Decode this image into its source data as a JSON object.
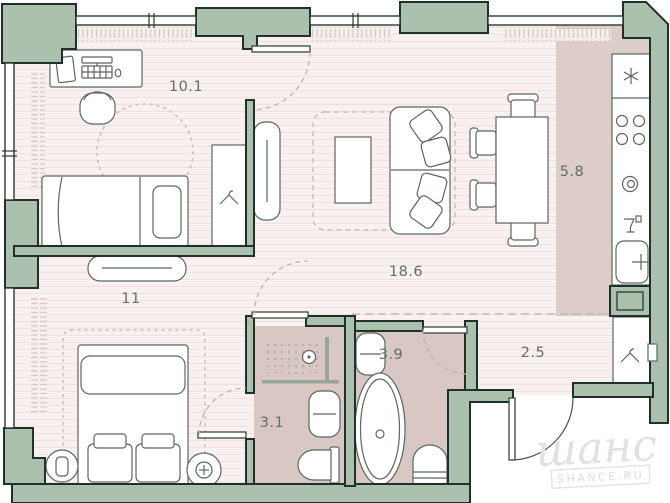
{
  "plan": {
    "areas": {
      "office": "10.1",
      "living": "18.6",
      "kitchen": "5.8",
      "bedroom": "11",
      "ensuite": "3.1",
      "bathroom": "3.9",
      "hallway": "2.5"
    },
    "watermark": {
      "script": "шанс",
      "caption": "SHANCE.RU"
    },
    "colors": {
      "wall": "#abc0ad",
      "wall_outline": "#20302a",
      "floor": "#f9f1f0",
      "floor_stripe": "#eee1e0",
      "wet_floor": "#d8c7c3",
      "kitchen_floor": "#dccdc8",
      "label": "#5f7065",
      "furniture_line": "#5b675f",
      "door_arc": "#c0b1ad",
      "watermark": "#e3e0dd"
    }
  }
}
